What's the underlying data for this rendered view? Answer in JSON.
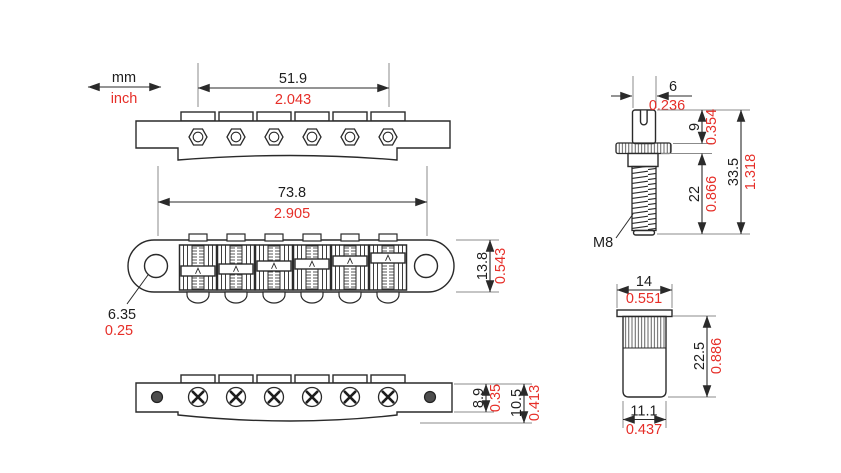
{
  "units_legend": {
    "metric": "mm",
    "imperial": "inch"
  },
  "colors": {
    "line": "#2a2a2a",
    "metric_text": "#1d1d1d",
    "imperial_text": "#e62e28"
  },
  "part_labels": {
    "thread_size": "M8"
  },
  "dimensions": {
    "saddle_spread": {
      "mm": "51.9",
      "inch": "2.043"
    },
    "post_spacing": {
      "mm": "73.8",
      "inch": "2.905"
    },
    "bridge_width": {
      "mm": "13.8",
      "inch": "0.543"
    },
    "post_hole_diameter": {
      "mm": "6.35",
      "inch": "0.25"
    },
    "plate_height": {
      "mm": "8.9",
      "inch": "0.35"
    },
    "overall_height": {
      "mm": "10.5",
      "inch": "0.413"
    },
    "stud_tip_diameter": {
      "mm": "6",
      "inch": "0.236"
    },
    "stud_head_height": {
      "mm": "9",
      "inch": "0.354"
    },
    "stud_thread_length": {
      "mm": "22",
      "inch": "0.866"
    },
    "stud_overall_length": {
      "mm": "33.5",
      "inch": "1.318"
    },
    "bushing_flange_diameter": {
      "mm": "14",
      "inch": "0.551"
    },
    "bushing_length": {
      "mm": "22.5",
      "inch": "0.886"
    },
    "bushing_body_diameter": {
      "mm": "11.1",
      "inch": "0.437"
    }
  }
}
